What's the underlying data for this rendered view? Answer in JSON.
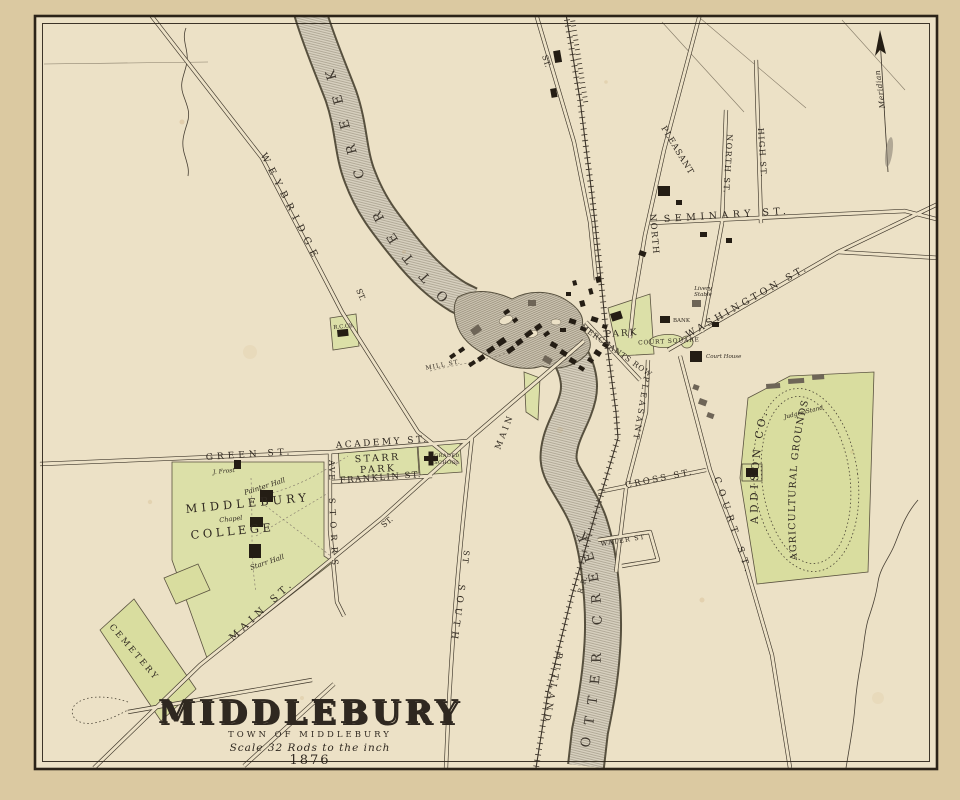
{
  "map": {
    "title": "MIDDLEBURY",
    "subtitle": "TOWN OF MIDDLEBURY",
    "scale_note": "Scale 32 Rods to the inch",
    "year": "1876",
    "meridian_label": "Meridian"
  },
  "waterways": {
    "otter_creek_upper": "OTTER CREEK",
    "otter_creek_lower": "OTTER CREEK"
  },
  "railroad": {
    "name": "RUTLAND",
    "initials": "R. R."
  },
  "streets": {
    "weybridge": "WEYBRIDGE",
    "weybridge_st": "ST.",
    "main_lower": "MAIN ST.",
    "main_mid": "MAIN",
    "main_st": "ST.",
    "south_1": "SOUTH",
    "south_2": "ST",
    "storrs_1": "STORRS",
    "storrs_2": "AVE",
    "green": "GREEN ST.",
    "academy": "ACADEMY ST.",
    "franklin": "FRANKLIN ST.",
    "seminary": "SEMINARY ST.",
    "north_pleasant_1": "NORTH",
    "north_pleasant_2": "PLEASANT",
    "north": "NORTH ST.",
    "high": "HIGH ST.",
    "washington": "WASHINGTON ST.",
    "merchants_row": "MERCHANTS ROW",
    "pleasant": "PLEASANT",
    "cross": "CROSS ST.",
    "water": "WATER ST",
    "court": "COURT ST.",
    "mill": "MILL ST.",
    "st_top": "ST."
  },
  "places": {
    "starr_park_line1": "STARR",
    "starr_park_line2": "PARK",
    "graded_school_line1": "GRADED",
    "graded_school_line2": "SCHOOL",
    "college_line1": "MIDDLEBURY",
    "college_line2": "COLLEGE",
    "park": "PARK",
    "court_square": "COURT SQUARE",
    "cemetery": "CEMETERY",
    "agricultural_line1": "ADDISON CO.",
    "agricultural_line2": "AGRICULTURAL GROUNDS",
    "judges_stand": "Judges Stand",
    "catholic_church": "R.C.Ch.",
    "bank": "BANK",
    "livery_line1": "Livery",
    "livery_line2": "Stable",
    "court_house": "Court House"
  },
  "college_buildings": {
    "painter_hall": "Painter Hall",
    "chapel": "Chapel",
    "starr_hall": "Starr Hall",
    "j_frost": "J. Frost"
  },
  "colors": {
    "parchment": "#ece1c6",
    "margin": "#dbc9a1",
    "plot_green": "#dce0a8",
    "ink": "#2f2820",
    "water_gray": "#d7d0bf"
  }
}
